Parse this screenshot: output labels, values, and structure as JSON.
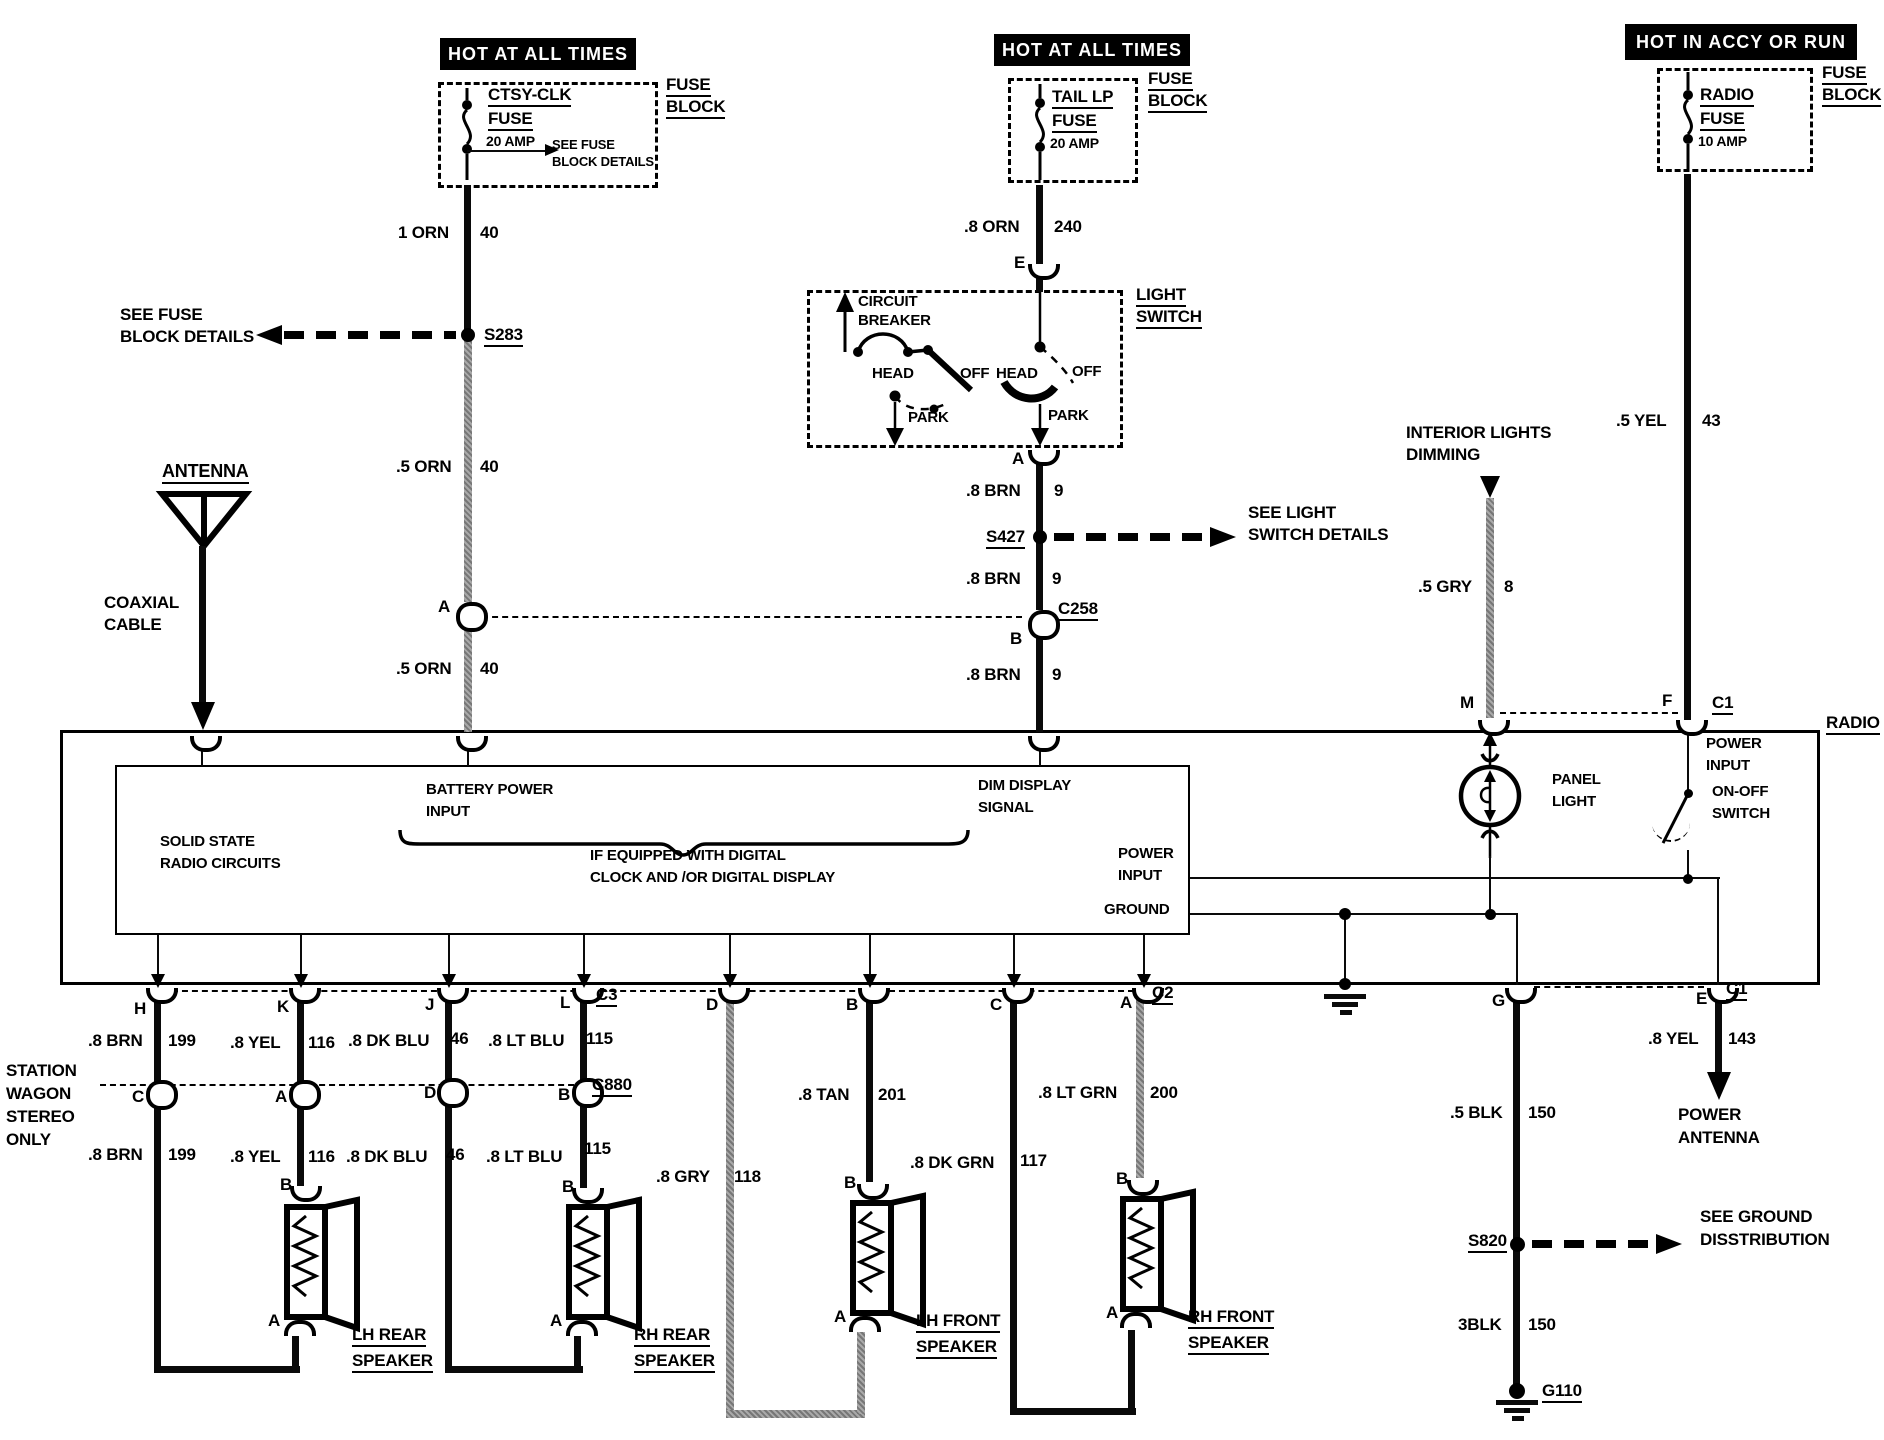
{
  "banners": {
    "left": "HOT AT ALL TIMES",
    "middle": "HOT AT ALL TIMES",
    "right": "HOT IN ACCY OR RUN"
  },
  "fuse1": {
    "name1": "CTSY-CLK",
    "name2": "FUSE",
    "amp": "20 AMP",
    "note1": "SEE FUSE",
    "note2": "BLOCK DETAILS",
    "blk1": "FUSE",
    "blk2": "BLOCK"
  },
  "fuse2": {
    "name1": "TAIL LP",
    "name2": "FUSE",
    "amp": "20 AMP",
    "blk1": "FUSE",
    "blk2": "BLOCK"
  },
  "fuse3": {
    "name1": "RADIO",
    "name2": "FUSE",
    "amp": "10 AMP",
    "blk1": "FUSE",
    "blk2": "BLOCK"
  },
  "left": {
    "w1": "1 ORN",
    "w1n": "40",
    "see1": "SEE FUSE",
    "see2": "BLOCK DETAILS",
    "splice": "S283",
    "w2": ".5 ORN",
    "w2n": "40",
    "a": "A",
    "w3": ".5 ORN",
    "w3n": "40"
  },
  "antenna": {
    "label": "ANTENNA",
    "coax1": "COAXIAL",
    "coax2": "CABLE"
  },
  "lswitch": {
    "w1": ".8 ORN",
    "w1n": "240",
    "e": "E",
    "t1": "LIGHT",
    "t2": "SWITCH",
    "cb1": "CIRCUIT",
    "cb2": "BREAKER",
    "head_l": "HEAD",
    "off_l": "OFF",
    "park_l": "PARK",
    "head_r": "HEAD",
    "off_r": "OFF",
    "park_r": "PARK",
    "a": "A",
    "w2": ".8 BRN",
    "w2n": "9",
    "splice": "S427",
    "see1": "SEE LIGHT",
    "see2": "SWITCH DETAILS",
    "w3": ".8 BRN",
    "w3n": "9",
    "conn": "C258",
    "b": "B",
    "w4": ".8 BRN",
    "w4n": "9"
  },
  "dimming": {
    "t1": "INTERIOR LIGHTS",
    "t2": "DIMMING",
    "w": ".5 GRY",
    "wn": "8",
    "m": "M"
  },
  "accy": {
    "w": ".5 YEL",
    "wn": "43",
    "f": "F",
    "conn": "C1"
  },
  "radio": {
    "label": "RADIO",
    "ss1": "SOLID STATE",
    "ss2": "RADIO CIRCUITS",
    "batt1": "BATTERY POWER",
    "batt2": "INPUT",
    "dig1": "IF EQUIPPED WITH DIGITAL",
    "dig2": "CLOCK AND /OR DIGITAL DISPLAY",
    "dimd1": "DIM DISPLAY",
    "dimd2": "SIGNAL",
    "pwr1": "POWER",
    "pwr2": "INPUT",
    "gnd": "GROUND",
    "pnl1": "PANEL",
    "pnl2": "LIGHT",
    "pit1": "POWER",
    "pit2": "INPUT",
    "sw1": "ON-OFF",
    "sw2": "SWITCH"
  },
  "conns": {
    "h": "H",
    "k": "K",
    "j": "J",
    "l": "L",
    "c3": "C3",
    "d": "D",
    "b": "B",
    "c": "C",
    "a": "A",
    "c2": "C2",
    "g": "G",
    "e": "E",
    "c1": "C1"
  },
  "wagon": {
    "l1": "STATION",
    "l2": "WAGON",
    "l3": "STEREO",
    "l4": "ONLY"
  },
  "row1": {
    "brn": ".8 BRN",
    "brnn": "199",
    "yel": ".8 YEL",
    "yeln": "116",
    "dkblu": ".8 DK BLU",
    "dkblun": "46",
    "ltblu": ".8 LT BLU",
    "ltblun": "115"
  },
  "c880": {
    "c": "C",
    "a": "A",
    "d": "D",
    "b": "B",
    "label": "C880"
  },
  "row2": {
    "brn": ".8 BRN",
    "brnn": "199",
    "yel": ".8 YEL",
    "yeln": "116",
    "dkblu": ".8 DK BLU",
    "dkblun": "46",
    "ltblu": ".8 LT BLU",
    "ltblun": "115"
  },
  "front": {
    "gry": ".8 GRY",
    "gryn": "118",
    "tan": ".8 TAN",
    "tann": "201",
    "dkgrn": ".8 DK GRN",
    "dkgrnn": "117",
    "ltgrn": ".8 LT GRN",
    "ltgrnn": "200"
  },
  "groundckt": {
    "w1": ".5 BLK",
    "w1n": "150",
    "splice": "S820",
    "see1": "SEE GROUND",
    "see2": "DISSTRIBUTION",
    "w2": "3BLK",
    "w2n": "150",
    "g": "G110"
  },
  "pantenna": {
    "w": ".8 YEL",
    "wn": "143",
    "t1": "POWER",
    "t2": "ANTENNA"
  },
  "speakers": {
    "b": "B",
    "a": "A",
    "lr1": "LH REAR",
    "lr2": "SPEAKER",
    "rr1": "RH REAR",
    "rr2": "SPEAKER",
    "lf1": "LH FRONT",
    "lf2": "SPEAKER",
    "rf1": "RH FRONT",
    "rf2": "SPEAKER"
  }
}
